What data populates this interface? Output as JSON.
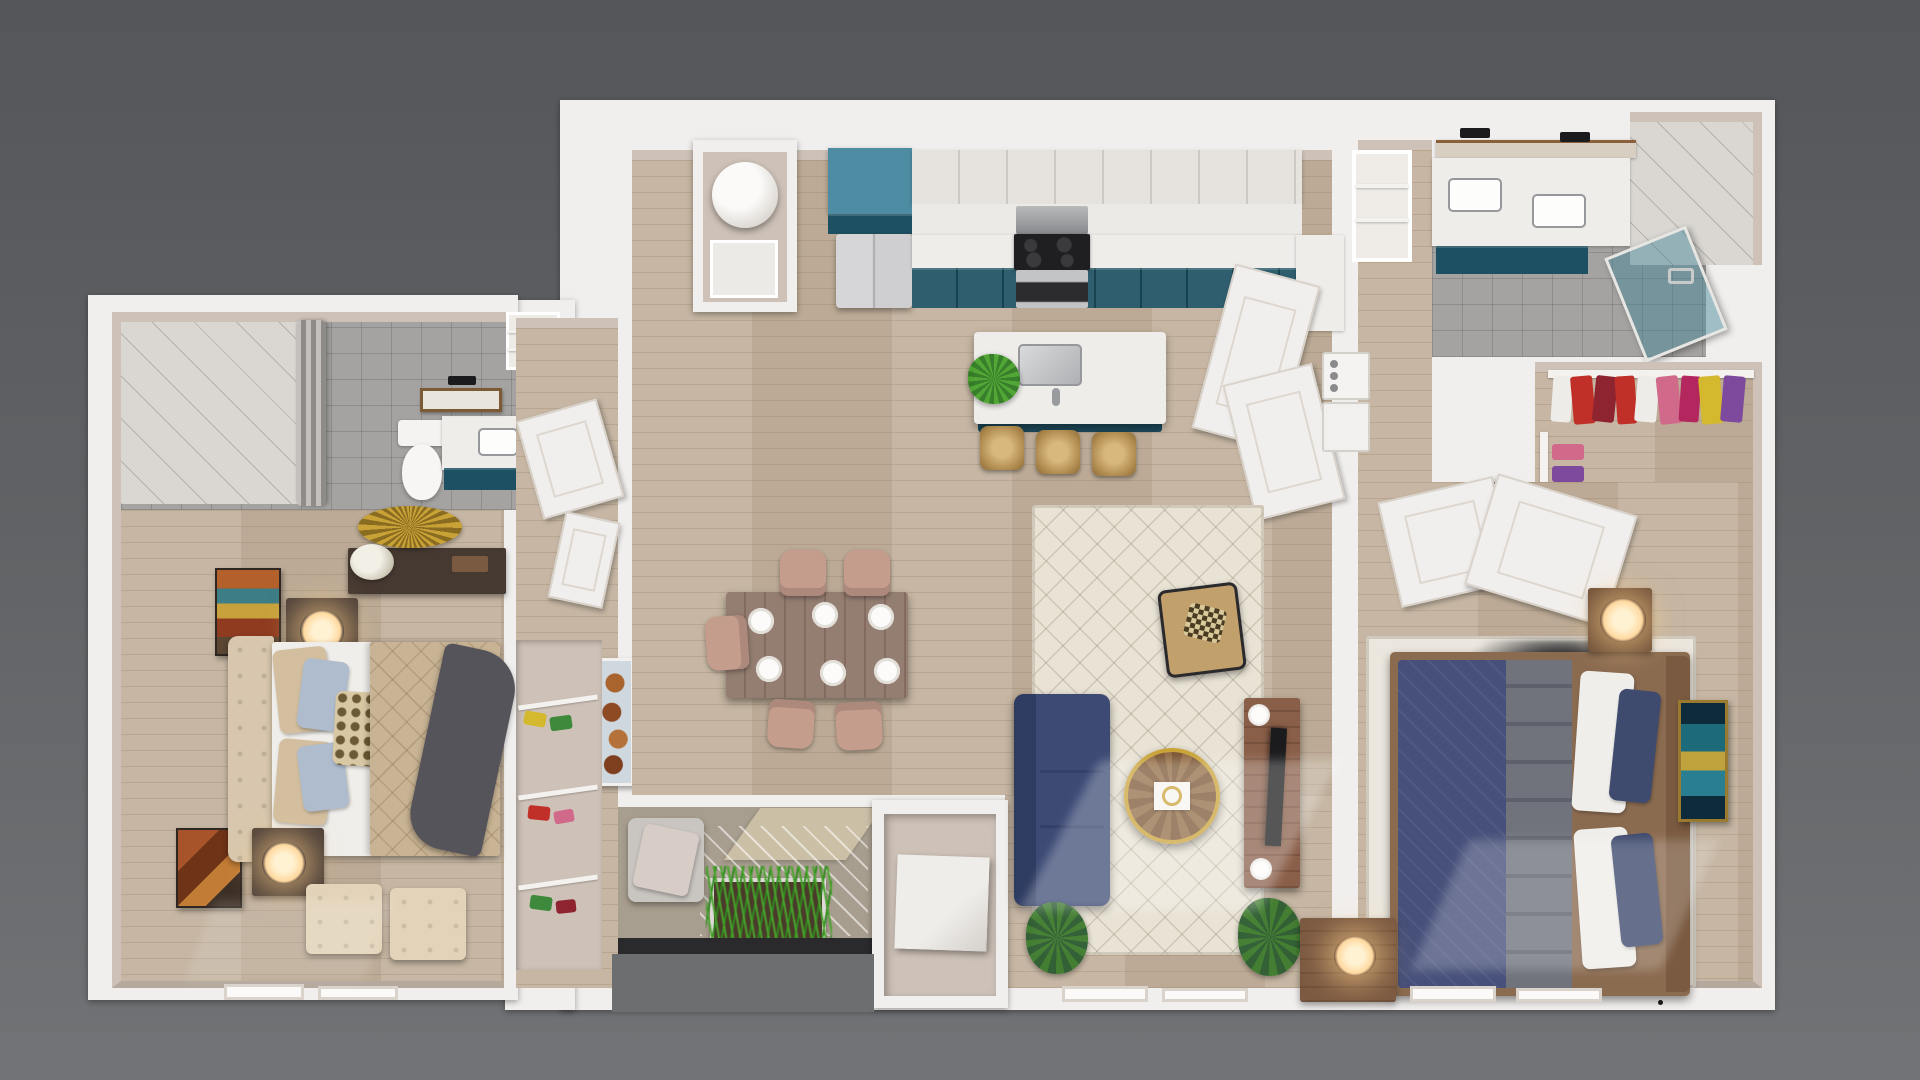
{
  "meta": {
    "scene": "3d-apartment-floor-plan-render",
    "view": "top-down dollhouse",
    "visible_text": "none"
  },
  "palette": {
    "bg_top": "#54565a",
    "bg_bottom": "#717376",
    "wall": "#f1efed",
    "wallface": "#cec2b8",
    "wallface_dark": "#b5a89d",
    "wood": "#c2b19d",
    "tile": "#a4a3a1",
    "marble": "#dad7d2",
    "concrete": "#a89e8f",
    "teal": "#1d5062",
    "teal_light": "#4e8ca4",
    "counter": "#efedea",
    "navy_sofa": "#3c4a74",
    "rug_cream": "#e9e3d5",
    "rug_spot": "#ece7de",
    "bed_navy": "#47507a",
    "bed_gray": "#70737c",
    "sheet": "#f0eeea",
    "tan_comforter": "#c8b394",
    "headboard_tan": "#d8c7ae",
    "throw_gray": "#54545a",
    "blush": "#c59d8d",
    "table_wood": "#8d7568",
    "cof_wood": "#7b5735",
    "gold": "#c9a237",
    "console_wood": "#8a5f49",
    "night_wood": "#4e4039",
    "dresser_wood": "#463931",
    "glow": "#ffd9a0",
    "leaf": "#3e7c2e",
    "leaf_dark": "#2c5c30",
    "grass": "#49a32c",
    "soil": "#4a3a2a",
    "steel": "#c7c7c9",
    "black": "#1b1b1d",
    "cl_red": "#c03028",
    "cl_maroon": "#8e2430",
    "cl_pink": "#d16a8a",
    "cl_magenta": "#b3265e",
    "cl_purple": "#7d4a9e",
    "cl_blue": "#3a6bc4",
    "cl_yellow": "#d4b82e",
    "cl_white": "#eeece8",
    "cl_green": "#3e8a3c"
  },
  "rooms": [
    {
      "id": "bedroom-2",
      "contents": [
        "tufted bed",
        "two nightstands with lamps",
        "dresser with sunburst mirror",
        "two ottomans",
        "wall art x2",
        "windows"
      ]
    },
    {
      "id": "bathroom-2",
      "contents": [
        "tiled shower with curtain",
        "toilet",
        "teal vanity with sink",
        "mirror",
        "sconce",
        "linen shelves"
      ]
    },
    {
      "id": "hall-closets",
      "contents": [
        "open doors",
        "food wall art",
        "shoe and storage shelves"
      ]
    },
    {
      "id": "kitchen",
      "contents": [
        "water heater closet",
        "blue pantry cabinet",
        "refrigerator",
        "white upper cabinets",
        "teal base cabinets",
        "range with microwave",
        "island with sink and plant",
        "three wicker stools"
      ]
    },
    {
      "id": "dining",
      "contents": [
        "wood table",
        "six blush chairs",
        "place settings"
      ]
    },
    {
      "id": "living",
      "contents": [
        "navy sofa",
        "cream moroccan rug",
        "round wood coffee table",
        "accent chair",
        "media console with tv",
        "plants",
        "windows"
      ]
    },
    {
      "id": "patio",
      "contents": [
        "lounge chair",
        "grass planter",
        "striped mat",
        "storage closet with cube table",
        "dark threshold"
      ]
    },
    {
      "id": "master-bathroom",
      "contents": [
        "double vanity with two sinks",
        "sconces",
        "teal cabinets",
        "glass shower",
        "marble walk-in shower",
        "stacked washer dryer",
        "linen shelves"
      ]
    },
    {
      "id": "walk-in-closet",
      "contents": [
        "hanging colorful clothes",
        "folded clothes shelves"
      ]
    },
    {
      "id": "master-bedroom",
      "contents": [
        "navy and gray bed with wood frame",
        "nightstand with lit lamp",
        "speckled rug",
        "teal abstract art",
        "dresser with lamp",
        "closet door panels",
        "windows"
      ]
    }
  ]
}
